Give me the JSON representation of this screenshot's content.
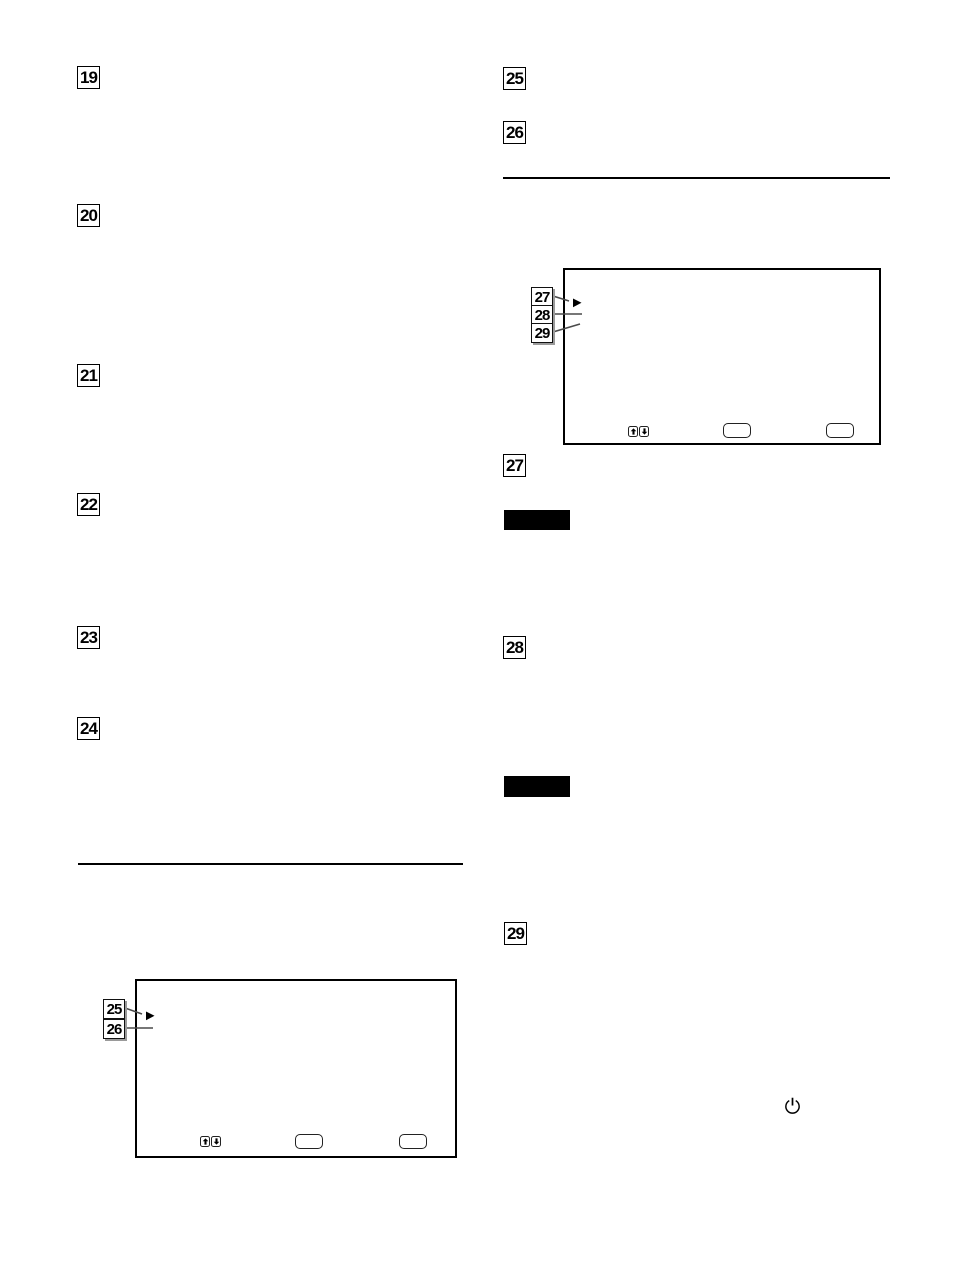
{
  "page": {
    "background_color": "#ffffff",
    "ink_color": "#000000"
  },
  "section_markers": {
    "left_column": [
      "19",
      "20",
      "21",
      "22",
      "23",
      "24"
    ],
    "right_column_top": [
      "25",
      "26"
    ],
    "right_column_body": [
      "27",
      "28",
      "29"
    ]
  },
  "figures": {
    "left_screen": {
      "callouts": [
        "25",
        "26"
      ],
      "cursor_icon": "right-triangle-menu-cursor",
      "footer_icons": [
        "up-arrow-button",
        "down-arrow-button"
      ],
      "footer_button_count": 2
    },
    "right_screen": {
      "callouts": [
        "27",
        "28",
        "29"
      ],
      "cursor_icon": "right-triangle-menu-cursor",
      "footer_icons": [
        "up-arrow-button",
        "down-arrow-button"
      ],
      "footer_button_count": 2
    }
  },
  "note_labels": [
    {
      "style": "solid-black-bar",
      "text": ""
    },
    {
      "style": "solid-black-bar",
      "text": ""
    }
  ],
  "icons": {
    "power": "power-symbol"
  }
}
